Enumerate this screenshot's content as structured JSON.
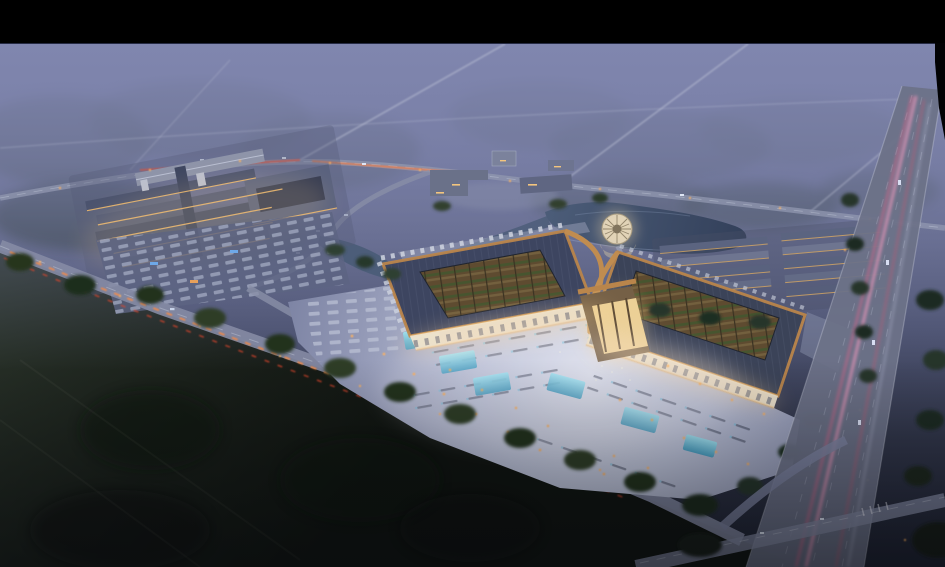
{
  "scene": {
    "title": "Aerial dusk rendering of a traditional-roofed market complex with illuminated plaza",
    "kind": "architectural-visualization",
    "time_of_day": "dusk",
    "elements": [
      "letterbox-bar",
      "misty-horizon",
      "forest-upper-left",
      "field-bottom-left",
      "upper-road",
      "diagonal-access-road",
      "highway",
      "bottom-cross-road",
      "left-market-complex",
      "left-parking-lot",
      "canal-pond",
      "round-pavilion",
      "hotel-buildings",
      "row-warehouses",
      "main-hall-west",
      "main-hall-east",
      "central-gate",
      "colonnades",
      "illuminated-plaza",
      "aqua-skylights",
      "taillight-streaks",
      "headlight-streaks",
      "street-lights",
      "tree-lines"
    ]
  },
  "palette": {
    "letterbox": "#000000",
    "mist_top": "#7f86b0",
    "haze_mid": "#6e7598",
    "forest_dark": "#2c3a31",
    "field_dark": "#161b16",
    "road_grey": "#9298b0",
    "highway_grey": "#6d7288",
    "taillight_orange": "#ff8a3e",
    "taillight_red": "#ff5636",
    "headlight_pink": "#ff9cc2",
    "roof_slate": "#3d4560",
    "roof_bronze": "#b9854b",
    "bronze_bright": "#d9a866",
    "warm_glow": "#ffd98f",
    "plaza_light": "#d6dae8",
    "aqua_glass": "#7fd2e8",
    "pond_water": "#45566f",
    "pavilion_roof": "#d6cdbb",
    "street_lamp": "#ffb35e",
    "car_light": "#dfe6f5"
  }
}
